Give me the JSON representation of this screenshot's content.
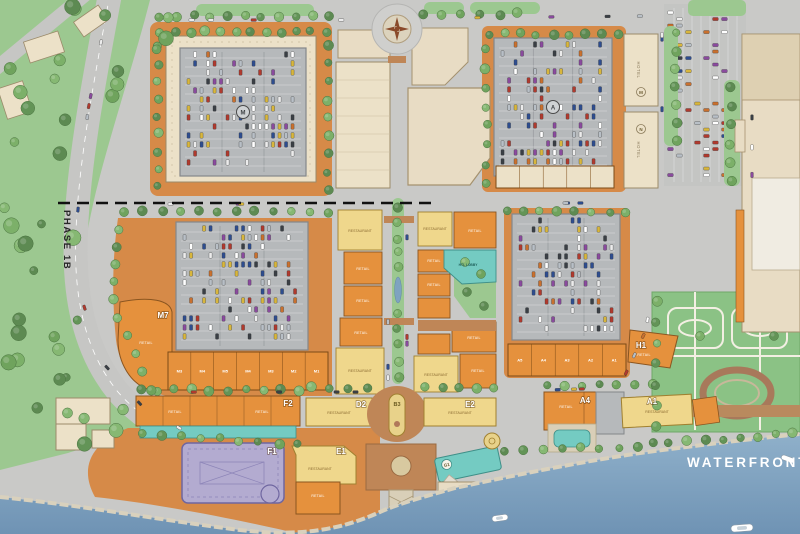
{
  "plan": {
    "phase_label": "PHASE 1B",
    "waterfront_label": "WATERFRONT STREET",
    "blocks": {
      "m7": "M7",
      "f2": "F2",
      "f1": "F1",
      "e1": "E1",
      "d2": "D2",
      "b3": "B3",
      "e2": "E2",
      "a4": "A4",
      "a1": "A1",
      "h1": "H1",
      "g1": "G1"
    },
    "building_types": {
      "retail": "RETAIL",
      "restaurant": "RESTAURANT",
      "hotel": "HOTEL",
      "hotel_lobby": "HTL LOBBY"
    },
    "garage_badges": {
      "west": "M",
      "east": "A"
    },
    "hotel_badges": {
      "upper": "M",
      "lower": "N"
    },
    "unit_codes": {
      "m_row": [
        "M3",
        "M4",
        "M5",
        "M4",
        "M3",
        "M2",
        "M1"
      ],
      "a_row": [
        "A5",
        "A4",
        "A3",
        "A2",
        "A1"
      ]
    },
    "colors": {
      "street": "#c9c9c7",
      "blockOrange": "#d68a48",
      "orange": "#e5913d",
      "cream": "#ece1c8",
      "tan": "#e8dcc4",
      "yellow": "#efd78c",
      "teal": "#74cbc2",
      "purple": "#b3abd0",
      "garage": "#b6b9bb",
      "park": "#9cc890",
      "garden": "#8bc285",
      "water1": "#8fb0ca",
      "water2": "#6f93b4",
      "brick": "#bf8657",
      "sand": "#d9cfb8"
    }
  }
}
